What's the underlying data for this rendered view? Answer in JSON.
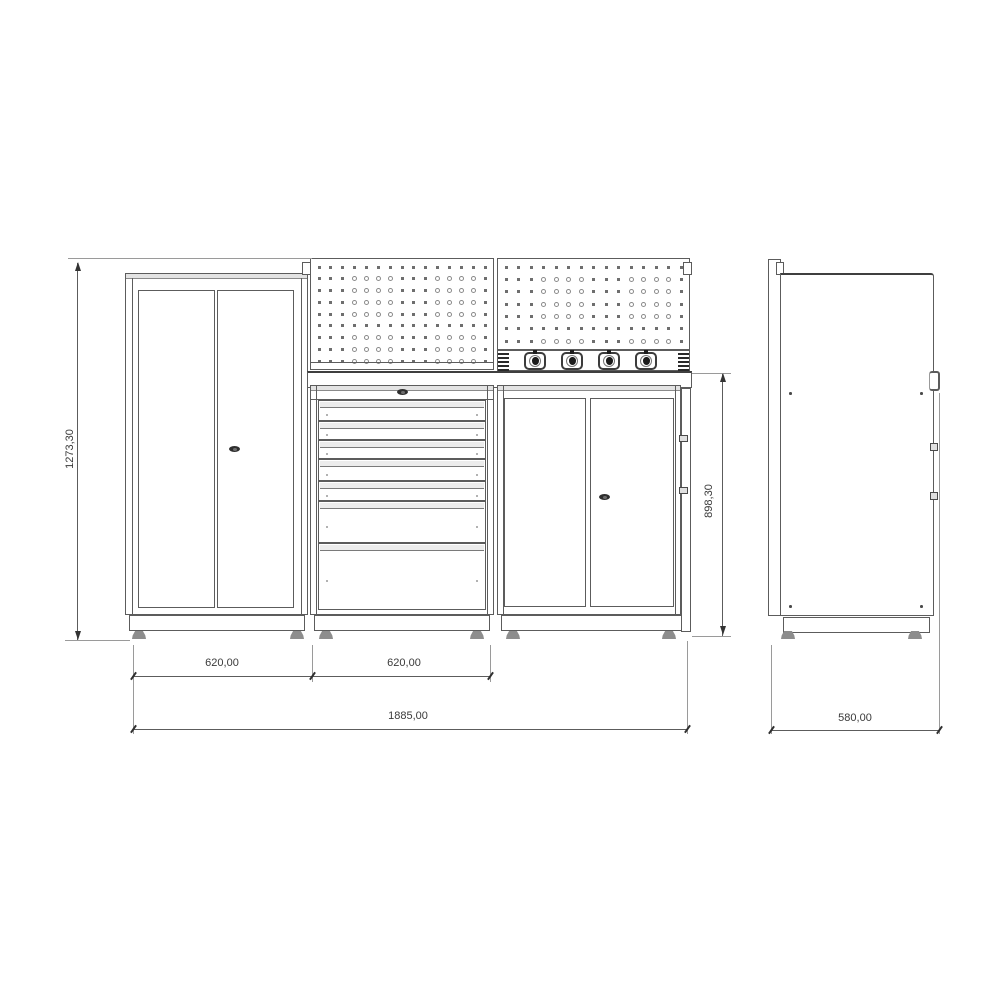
{
  "drawing": {
    "kind": "workshop-cabinet-technical-drawing",
    "views": {
      "front": "front-view",
      "side": "side-view"
    }
  },
  "dimensions": {
    "height_total": "1273,30",
    "width_left_module": "620,00",
    "width_middle_module": "620,00",
    "width_total": "1885,00",
    "height_worktop_to_floor": "898,30",
    "depth_total": "580,00"
  },
  "front_view": {
    "left_cabinet": {
      "doors": 2,
      "locks": 1
    },
    "middle_module": {
      "pegboard_cols": 15,
      "pegboard_rows": 9,
      "drawer_count": 7,
      "locks": 1
    },
    "right_module": {
      "pegboard_cols": 15,
      "pegboard_rows": 7,
      "socket_count": 4,
      "doors": 2,
      "locks": 1
    }
  },
  "colors": {
    "line": "#5c5c5c",
    "line_dark": "#3f3f3f",
    "background": "#ffffff",
    "hardware_dark": "#2e2e2e"
  }
}
